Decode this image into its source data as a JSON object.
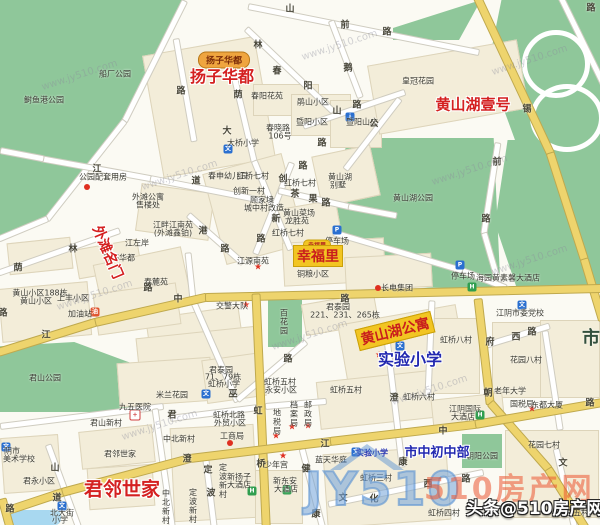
{
  "map": {
    "watermarks": {
      "tiled": "www.jy510.com",
      "big": "510房产网",
      "headline": "头条@510房产网",
      "logo": "JY510",
      "tiled_positions": [
        [
          40,
          70
        ],
        [
          300,
          40
        ],
        [
          490,
          55
        ],
        [
          140,
          170
        ],
        [
          430,
          165
        ],
        [
          55,
          290
        ],
        [
          270,
          330
        ],
        [
          490,
          255
        ],
        [
          120,
          420
        ],
        [
          390,
          385
        ]
      ]
    },
    "colors": {
      "park_green": "#8fc79a",
      "road_yellow": "#eed46d",
      "block_beige": "#f3edd9",
      "estate_red": "#d42020",
      "school_blue": "#2228b0",
      "highlight_yellow": "#f2c522",
      "badge_orange": "#efa53f",
      "watermark_orange": "rgba(235,85,50,0.55)",
      "logo_blue": "rgba(80,140,210,0.55)"
    },
    "estates": [
      {
        "t": "扬子华都",
        "kind": "badge",
        "x": 224,
        "y": 60,
        "size": 9
      },
      {
        "t": "扬子华都",
        "kind": "red",
        "x": 222,
        "y": 75,
        "size": 16
      },
      {
        "t": "黄山湖壹号",
        "kind": "red",
        "x": 473,
        "y": 104,
        "size": 15
      },
      {
        "t": "幸福里",
        "kind": "badge-mini",
        "x": 317,
        "y": 245,
        "size": 6
      },
      {
        "t": "幸福里",
        "kind": "red-hl",
        "x": 318,
        "y": 256,
        "size": 14
      },
      {
        "t": "外滩名门",
        "kind": "red",
        "x": 108,
        "y": 252,
        "size": 14,
        "rot": 67
      },
      {
        "t": "黄山湖公寓",
        "kind": "red-hl",
        "x": 395,
        "y": 331,
        "size": 14,
        "rot": -14
      },
      {
        "t": "实验小学",
        "kind": "blue",
        "x": 410,
        "y": 358,
        "size": 16
      },
      {
        "t": "市中初中部",
        "kind": "blue",
        "x": 437,
        "y": 451,
        "size": 13
      },
      {
        "t": "君邻世家",
        "kind": "red",
        "x": 122,
        "y": 488,
        "size": 19
      }
    ],
    "pois": [
      [
        "船厂公园",
        115,
        74
      ],
      [
        "鲥鱼港公园",
        44,
        100
      ],
      [
        "春阳花苑",
        267,
        96
      ],
      [
        "鹃山小区",
        313,
        102
      ],
      [
        "暨阳小区",
        312,
        122
      ],
      [
        "暨阳山庄",
        362,
        122
      ],
      [
        "春晓路",
        278,
        128
      ],
      [
        "106号",
        280,
        136
      ],
      [
        "大桥小学",
        243,
        143
      ],
      [
        "皇冠花园",
        418,
        81
      ],
      [
        "公园配套用房",
        103,
        177
      ],
      [
        "春申幼儿园",
        228,
        176
      ],
      [
        "红桥七村",
        253,
        176
      ],
      [
        "红桥七村",
        300,
        183
      ],
      [
        "创新一村",
        249,
        191
      ],
      [
        "顾家埭",
        262,
        200
      ],
      [
        "城中村改造",
        264,
        208
      ],
      [
        "黄山菜场",
        299,
        213
      ],
      [
        "龙胜苑",
        297,
        221
      ],
      [
        "红桥七村",
        288,
        233
      ],
      [
        "黄山湖",
        340,
        177
      ],
      [
        "别墅",
        338,
        185
      ],
      [
        "外滩公寓",
        148,
        197
      ],
      [
        "售楼处",
        148,
        205
      ],
      [
        "江畔江南苑",
        173,
        225
      ],
      [
        "(外滩鑫铂)",
        173,
        233
      ],
      [
        "江左岸",
        137,
        243
      ],
      [
        "春涛华都",
        119,
        258
      ],
      [
        "春麓苑",
        156,
        282
      ],
      [
        "黄山湖公园",
        413,
        198
      ],
      [
        "停车场",
        337,
        241
      ],
      [
        "停车场",
        463,
        276
      ],
      [
        "海园黄素馨大酒店",
        508,
        278
      ],
      [
        "铜粮小区",
        313,
        274
      ],
      [
        "长电集团",
        397,
        288
      ],
      [
        "江源南苑",
        253,
        261
      ],
      [
        "黄山小区188栋",
        40,
        293
      ],
      [
        "黄山小区",
        36,
        301
      ],
      [
        "上丰小区",
        73,
        298
      ],
      [
        "加油站",
        80,
        314
      ],
      [
        "交警大队",
        232,
        306
      ],
      [
        "百花园",
        284,
        322,
        "v"
      ],
      [
        "君泰园",
        338,
        307
      ],
      [
        "221、231、265栋",
        345,
        315
      ],
      [
        "君山公园",
        45,
        378
      ],
      [
        "米兰花园",
        172,
        395
      ],
      [
        "九五医院",
        135,
        407
      ],
      [
        "君泰园",
        221,
        370
      ],
      [
        "71、79栋",
        223,
        377
      ],
      [
        "虹桥小学",
        224,
        384
      ],
      [
        "虹桥五村",
        280,
        382
      ],
      [
        "永安小区",
        281,
        390
      ],
      [
        "虹桥五村",
        346,
        390
      ],
      [
        "虹桥六村",
        419,
        397
      ],
      [
        "虹桥八村",
        456,
        340
      ],
      [
        "花园八村",
        526,
        360
      ],
      [
        "江阴市委党校",
        520,
        313
      ],
      [
        "老年大学",
        510,
        391
      ],
      [
        "国税局",
        522,
        404
      ],
      [
        "东都大厦",
        547,
        405
      ],
      [
        "江阴国际",
        465,
        409
      ],
      [
        "大酒店",
        463,
        417
      ],
      [
        "花园七村",
        544,
        445
      ],
      [
        "朝阳公园",
        482,
        456
      ],
      [
        "蓝天华庭",
        331,
        460
      ],
      [
        "实验小学",
        372,
        453,
        "blue"
      ],
      [
        "虹桥三村",
        376,
        478
      ],
      [
        "虹桥四村",
        444,
        513
      ],
      [
        "花园五村",
        573,
        513
      ],
      [
        "虹桥北路",
        229,
        415
      ],
      [
        "外贸小区",
        230,
        423
      ],
      [
        "工商局",
        232,
        436
      ],
      [
        "地税局",
        277,
        422,
        "v"
      ],
      [
        "档案局",
        294,
        414,
        "v"
      ],
      [
        "邮政局",
        308,
        414,
        "v"
      ],
      [
        "少年宫",
        276,
        465
      ],
      [
        "新扬子",
        239,
        477
      ],
      [
        "大酒店",
        239,
        485
      ],
      [
        "新东安",
        285,
        481
      ],
      [
        "大酒店",
        286,
        489
      ],
      [
        "君山新村",
        106,
        423
      ],
      [
        "君邻世家",
        120,
        454
      ],
      [
        "中北新村",
        179,
        439
      ],
      [
        "中北新村",
        166,
        507,
        "v"
      ],
      [
        "定波新村",
        193,
        506,
        "v"
      ],
      [
        "定波新村",
        223,
        481,
        "v"
      ],
      [
        "阴市",
        12,
        451
      ],
      [
        "美术学校",
        19,
        459
      ],
      [
        "君永小区",
        39,
        481
      ],
      [
        "北大街",
        62,
        513
      ],
      [
        "小学",
        60,
        520
      ],
      [
        "市",
        591,
        337,
        "b"
      ]
    ],
    "road_labels": [
      [
        "山",
        290,
        8
      ],
      [
        "前",
        345,
        24
      ],
      [
        "路",
        387,
        31
      ],
      [
        "路",
        591,
        7
      ],
      [
        "林",
        258,
        44
      ],
      [
        "春",
        277,
        70
      ],
      [
        "阳",
        308,
        85
      ],
      [
        "鹅",
        348,
        67
      ],
      [
        "山",
        337,
        110
      ],
      [
        "路",
        357,
        104
      ],
      [
        "公",
        374,
        123
      ],
      [
        "路",
        322,
        142
      ],
      [
        "锡",
        527,
        108
      ],
      [
        "路",
        181,
        90
      ],
      [
        "荫",
        238,
        94
      ],
      [
        "大",
        227,
        130
      ],
      [
        "江",
        97,
        168
      ],
      [
        "道",
        196,
        180
      ],
      [
        "创",
        283,
        178
      ],
      [
        "路",
        303,
        165
      ],
      [
        "茶",
        295,
        193
      ],
      [
        "果",
        313,
        198
      ],
      [
        "路",
        326,
        202
      ],
      [
        "新",
        276,
        218
      ],
      [
        "路",
        261,
        238
      ],
      [
        "港",
        203,
        230
      ],
      [
        "路",
        225,
        248
      ],
      [
        "林",
        73,
        248
      ],
      [
        "荫",
        18,
        267
      ],
      [
        "前",
        497,
        161
      ],
      [
        "路",
        486,
        218
      ],
      [
        "江",
        46,
        334
      ],
      [
        "中",
        178,
        298
      ],
      [
        "路",
        345,
        298
      ],
      [
        "路",
        3,
        312
      ],
      [
        "路",
        148,
        287
      ],
      [
        "路",
        288,
        358
      ],
      [
        "巫",
        233,
        393
      ],
      [
        "澄",
        394,
        397
      ],
      [
        "朝",
        488,
        392
      ],
      [
        "府",
        490,
        341
      ],
      [
        "西",
        516,
        336
      ],
      [
        "路",
        532,
        331
      ],
      [
        "君",
        172,
        414
      ],
      [
        "山",
        55,
        467
      ],
      [
        "道",
        57,
        497
      ],
      [
        "路",
        10,
        508
      ],
      [
        "澄",
        187,
        458
      ],
      [
        "定",
        208,
        469
      ],
      [
        "波",
        211,
        492
      ],
      [
        "虹",
        258,
        410
      ],
      [
        "桥",
        261,
        463
      ],
      [
        "江",
        325,
        443
      ],
      [
        "中",
        443,
        430
      ],
      [
        "健",
        306,
        468
      ],
      [
        "康",
        316,
        513
      ],
      [
        "康",
        403,
        461
      ],
      [
        "文",
        343,
        497
      ],
      [
        "化",
        374,
        498
      ],
      [
        "西",
        428,
        483
      ],
      [
        "路",
        466,
        478
      ],
      [
        "文",
        563,
        462
      ],
      [
        "路",
        590,
        402
      ]
    ],
    "icons": [
      [
        "dot",
        87,
        187
      ],
      [
        "dot",
        378,
        288
      ],
      [
        "dot",
        230,
        443
      ],
      [
        "star",
        246,
        306
      ],
      [
        "star",
        258,
        268
      ],
      [
        "star",
        283,
        457
      ],
      [
        "star",
        276,
        437
      ],
      [
        "star",
        292,
        428
      ],
      [
        "star",
        532,
        410
      ],
      [
        "star",
        308,
        427
      ],
      [
        "star",
        379,
        356
      ],
      [
        "school",
        206,
        394
      ],
      [
        "school",
        356,
        452
      ],
      [
        "school",
        62,
        506
      ],
      [
        "school",
        6,
        447
      ],
      [
        "school",
        228,
        149
      ],
      [
        "school",
        400,
        346
      ],
      [
        "school",
        522,
        305
      ],
      [
        "p",
        337,
        230
      ],
      [
        "p",
        460,
        265
      ],
      [
        "hotel",
        472,
        287
      ],
      [
        "hotel",
        480,
        415
      ],
      [
        "hotel",
        252,
        491
      ],
      [
        "hotel",
        287,
        490
      ],
      [
        "hospital",
        135,
        415
      ],
      [
        "gas",
        95,
        312
      ],
      [
        "info",
        350,
        117
      ]
    ]
  }
}
